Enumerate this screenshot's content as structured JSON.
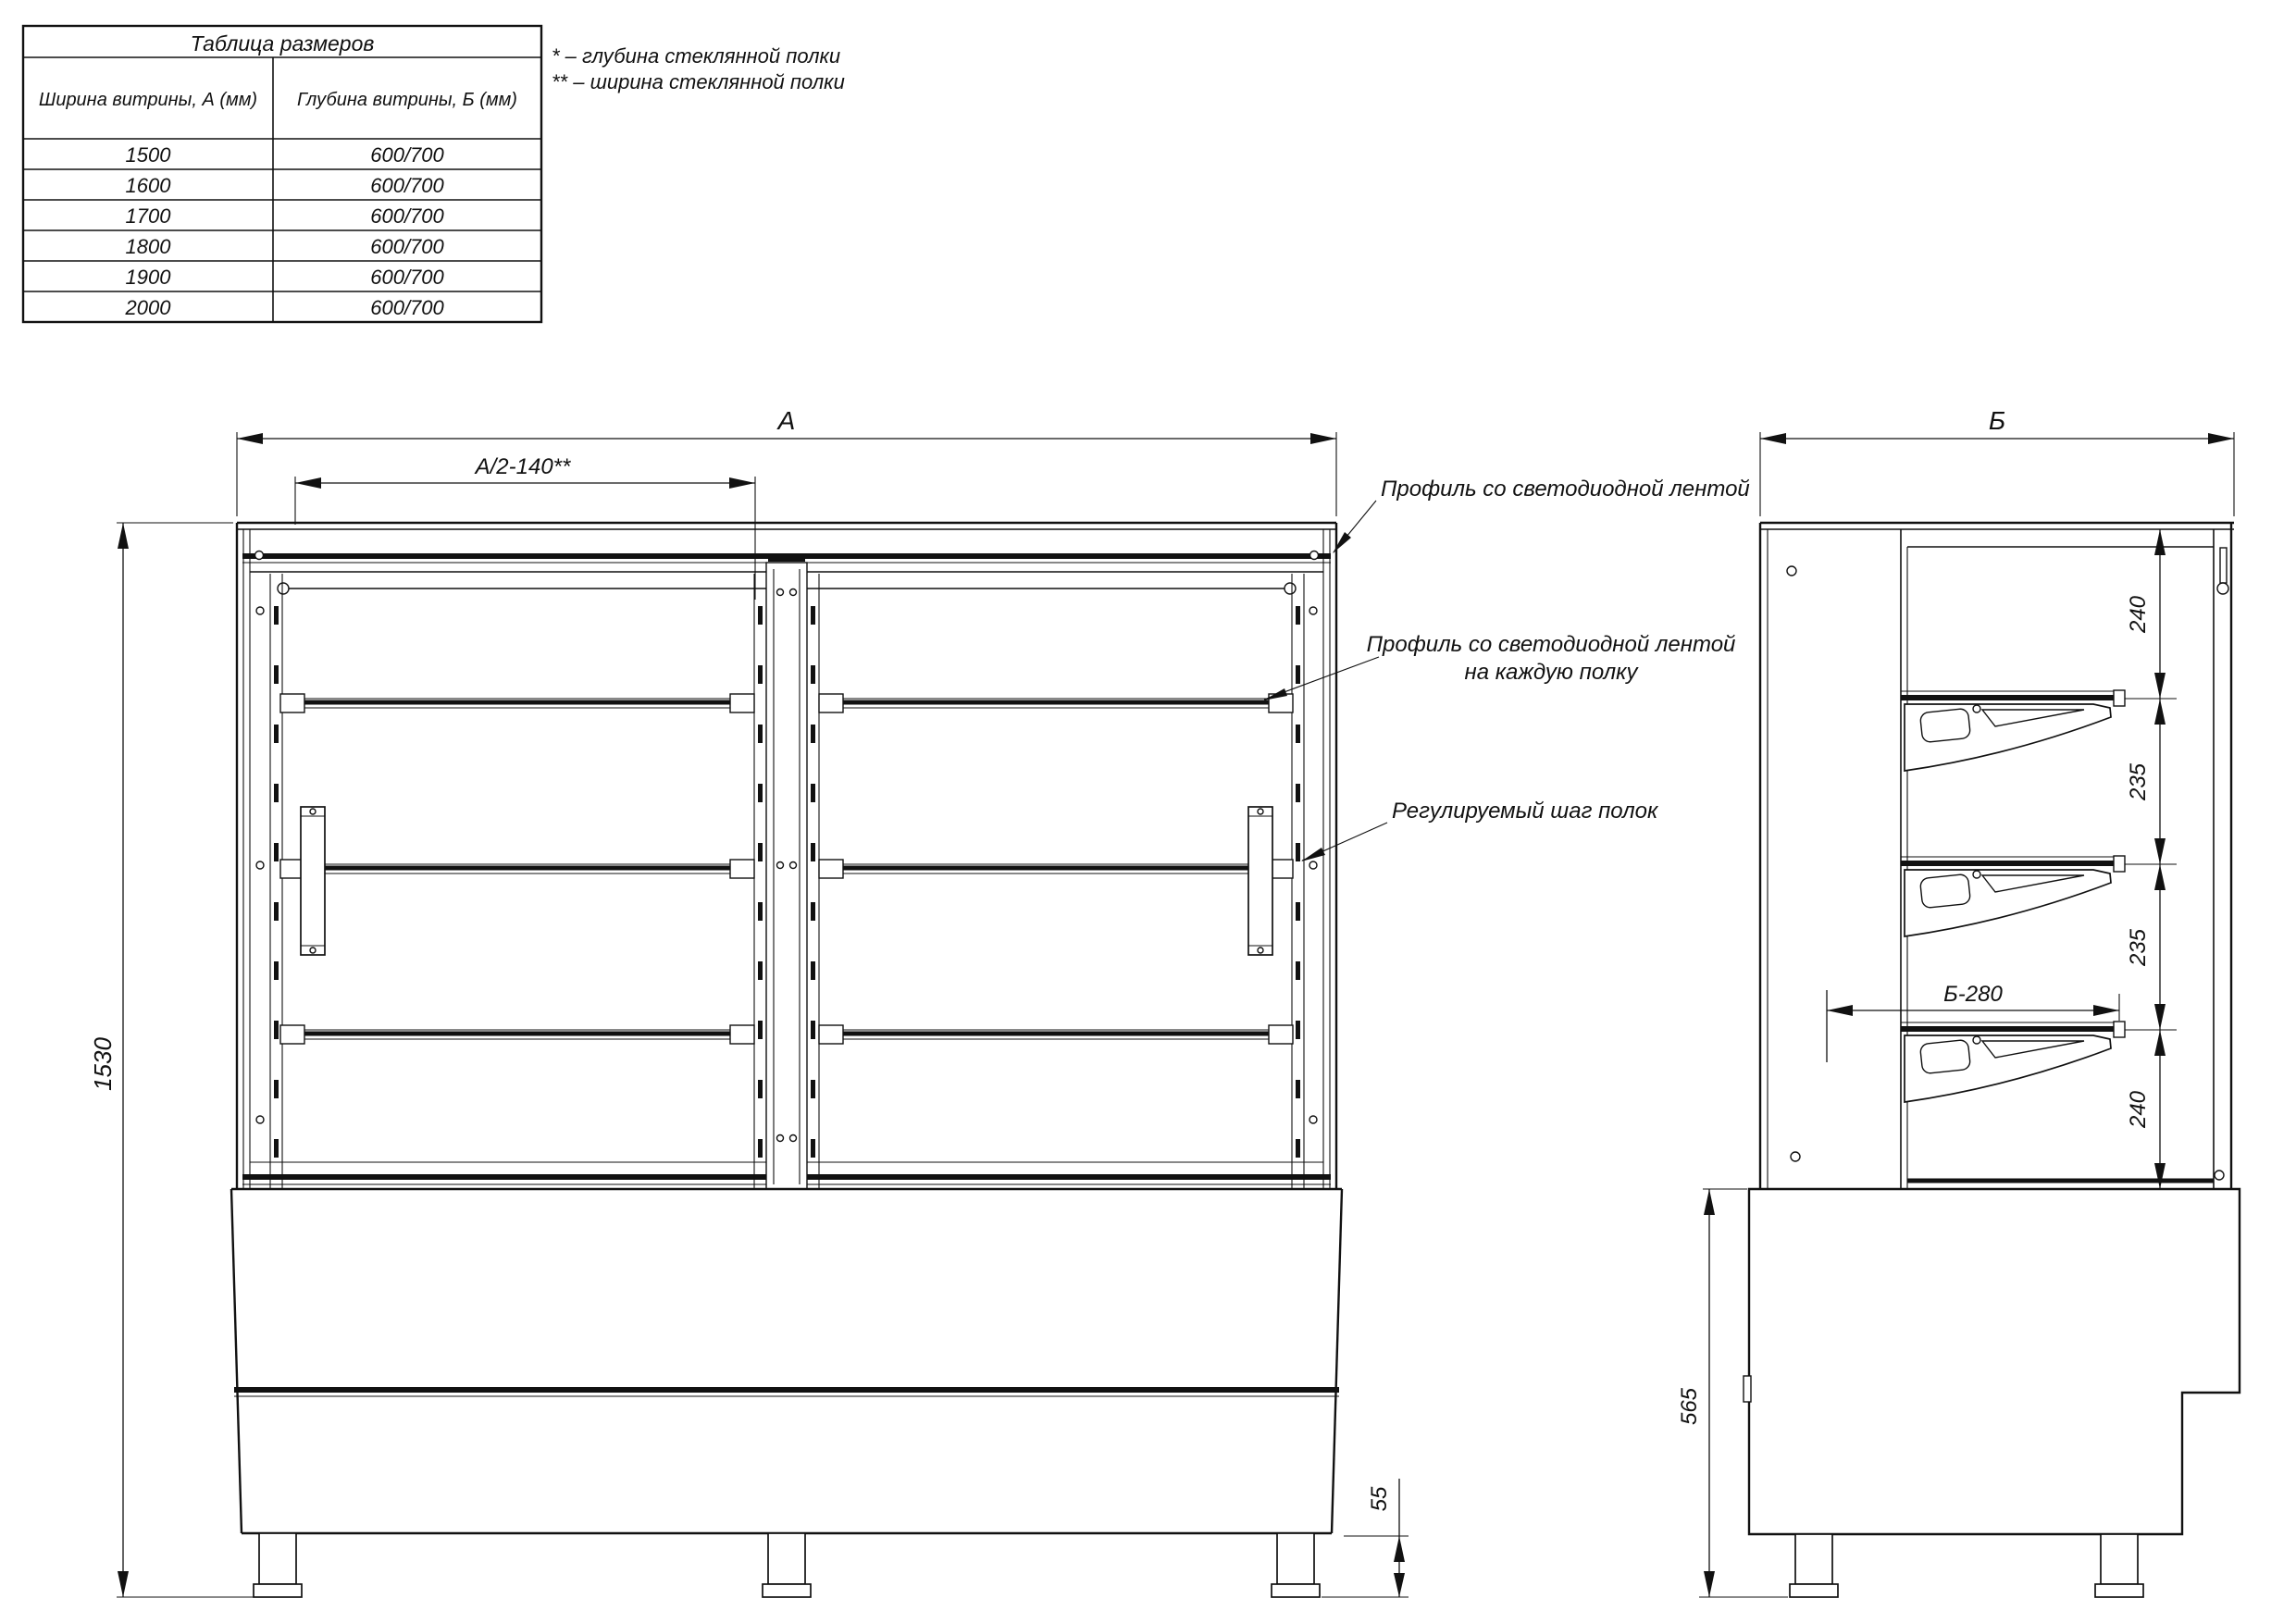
{
  "drawing": {
    "size_table": {
      "title": "Таблица размеров",
      "columns": [
        "Ширина витрины, А (мм)",
        "Глубина витрины, Б (мм)"
      ],
      "rows": [
        [
          "1500",
          "600/700"
        ],
        [
          "1600",
          "600/700"
        ],
        [
          "1700",
          "600/700"
        ],
        [
          "1800",
          "600/700"
        ],
        [
          "1900",
          "600/700"
        ],
        [
          "2000",
          "600/700"
        ]
      ]
    },
    "notes": [
      "* – глубина стеклянной полки",
      "** – ширина стеклянной полки"
    ],
    "front_view": {
      "dim_overall_width": "А",
      "dim_shelf_width": "А/2-140**",
      "dim_overall_height": "1530",
      "dim_foot_height": "55",
      "callout_led_canopy": "Профиль со светодиодной лентой",
      "callout_led_shelf_line1": "Профиль со светодиодной лентой",
      "callout_led_shelf_line2": "на каждую полку",
      "callout_shelf_step": "Регулируемый шаг полок"
    },
    "side_view": {
      "dim_overall_depth": "Б",
      "step_dims": [
        "240",
        "235",
        "235",
        "240"
      ],
      "dim_shelf_depth": "Б-280",
      "dim_base_height": "565"
    },
    "colors": {
      "ink": "#111111",
      "paper": "#ffffff"
    }
  }
}
